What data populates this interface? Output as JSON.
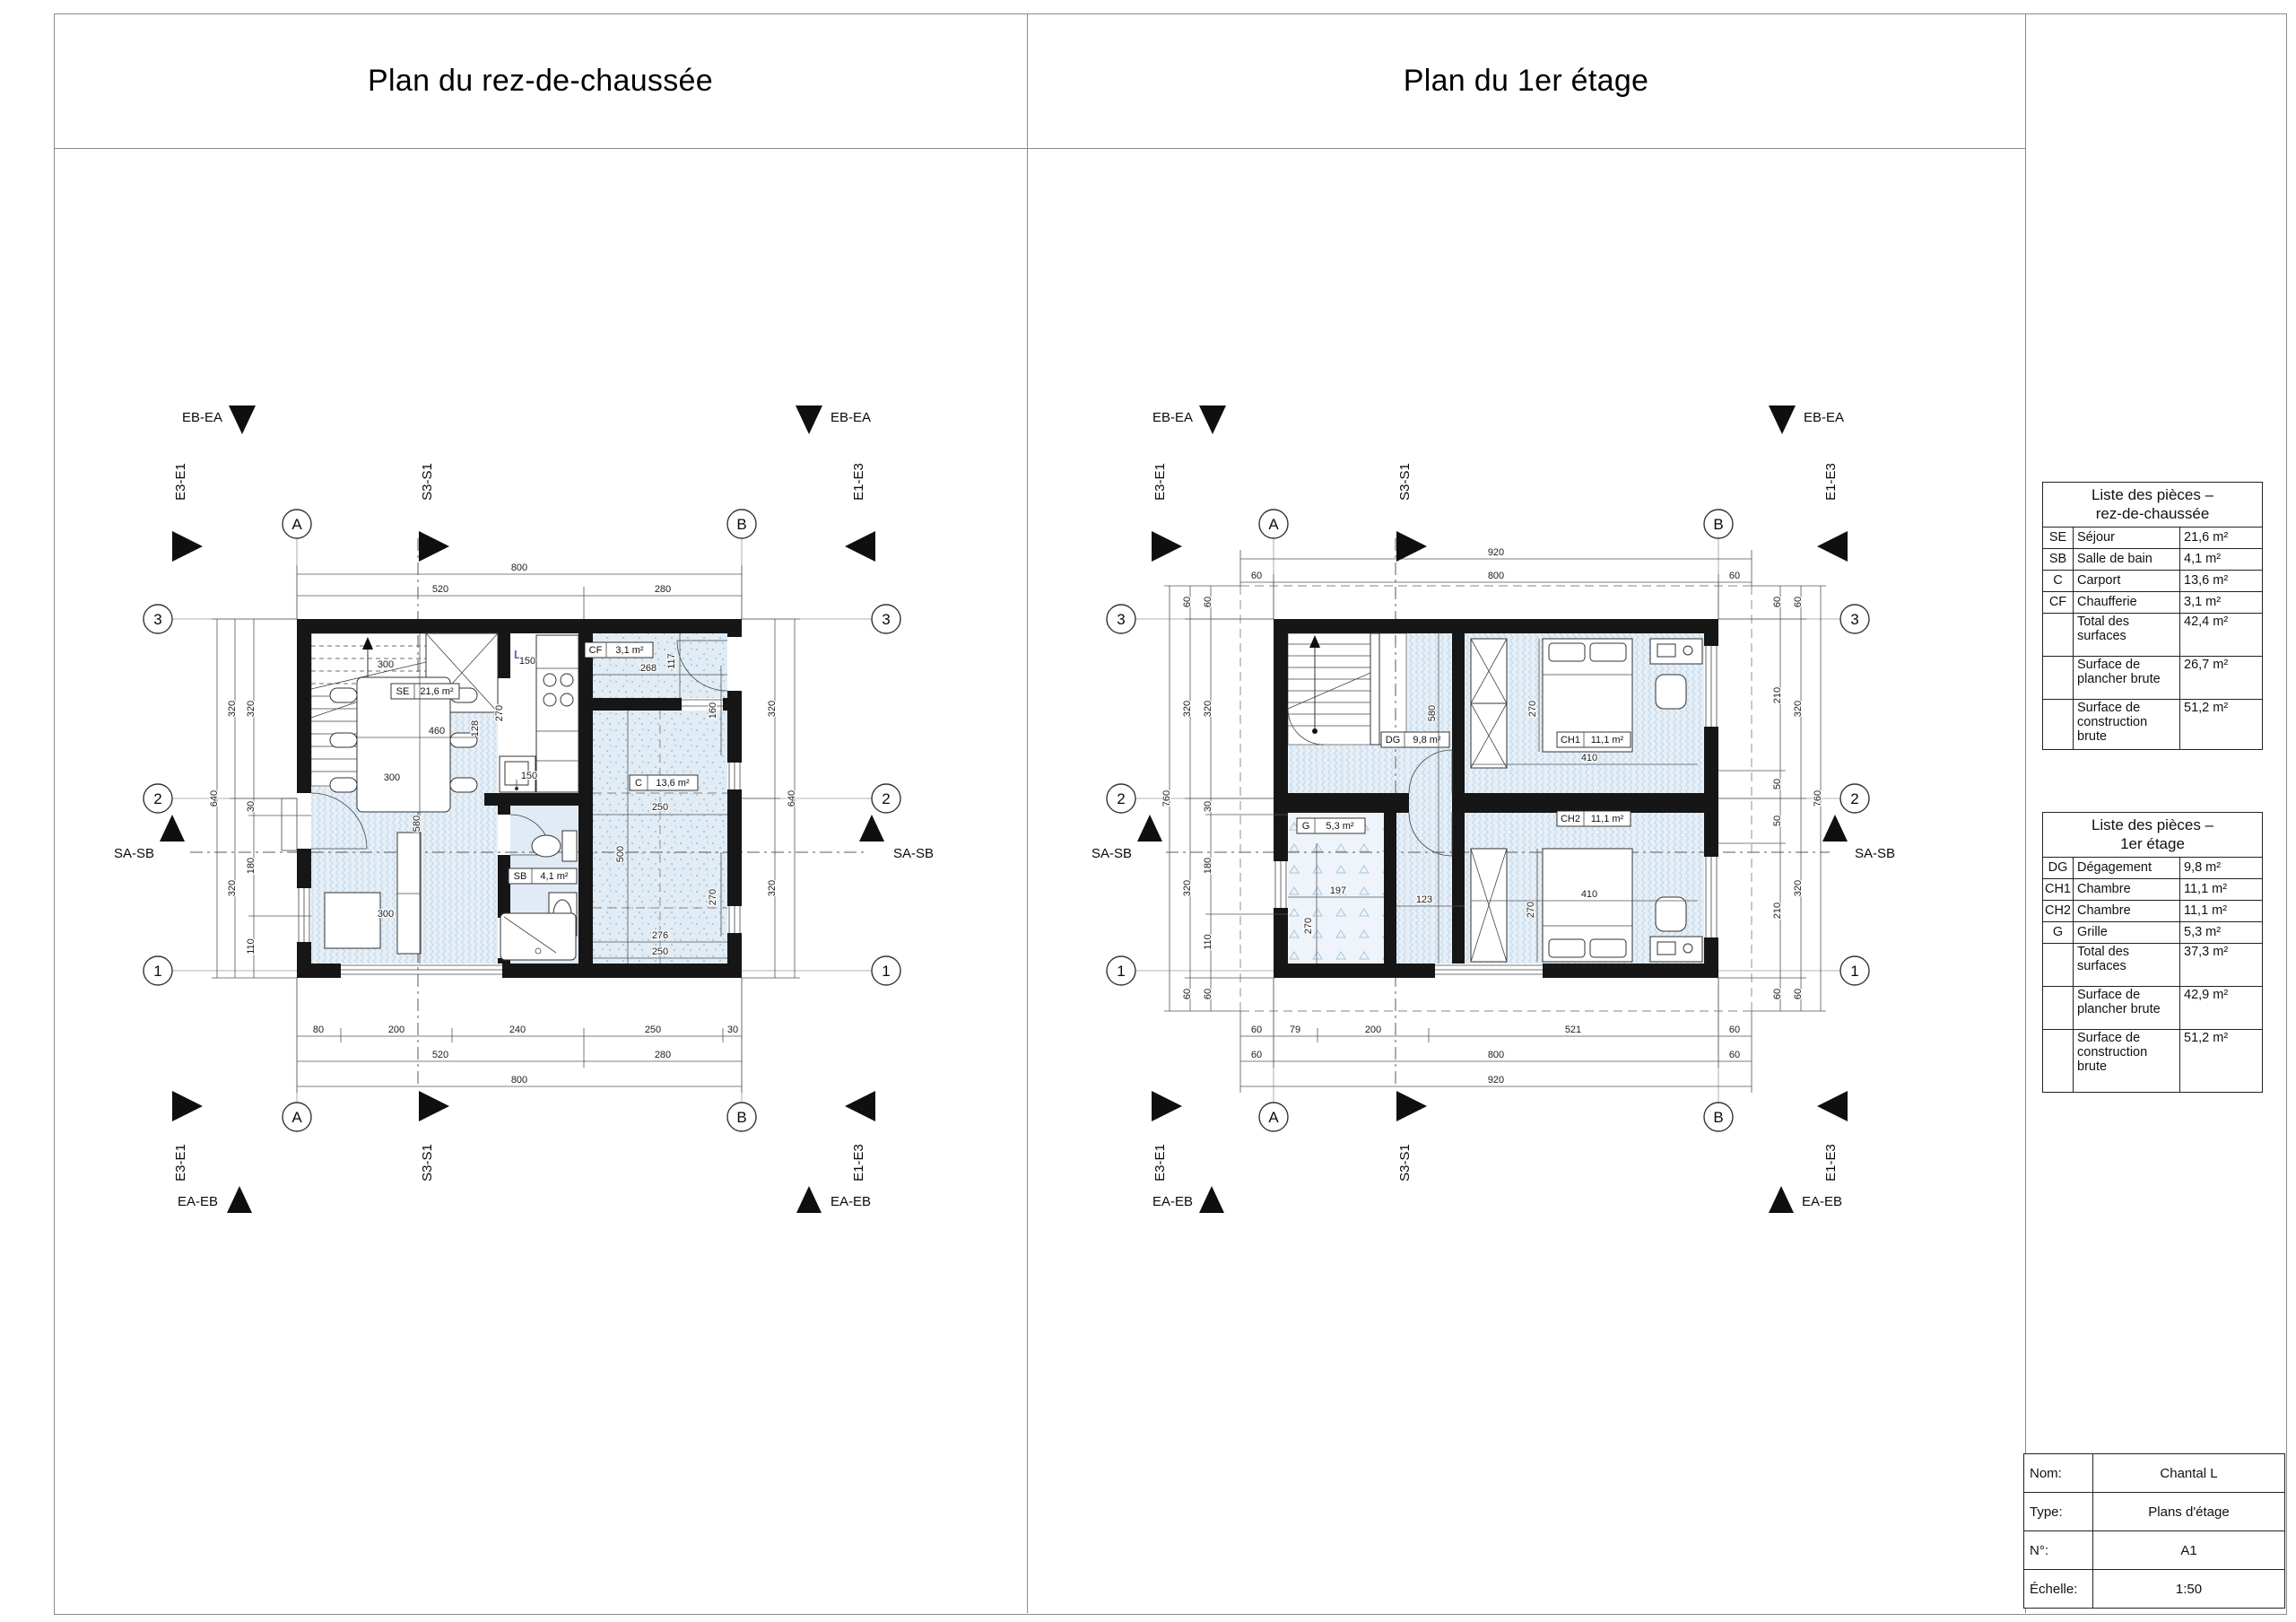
{
  "sheet": {
    "title_left": "Plan du rez-de-chaussée",
    "title_right": "Plan du 1er étage"
  },
  "markers": {
    "grid_a": "A",
    "grid_b": "B",
    "grid_1": "1",
    "grid_2": "2",
    "grid_3": "3",
    "eb_ea": "EB-EA",
    "ea_eb": "EA-EB",
    "e3_e1": "E3-E1",
    "e1_e3": "E1-E3",
    "s3_s1": "S3-S1",
    "sa_sb": "SA-SB"
  },
  "plan1": {
    "rooms": {
      "se": {
        "code": "SE",
        "area": "21,6 m²"
      },
      "sb": {
        "code": "SB",
        "area": "4,1 m²"
      },
      "c": {
        "code": "C",
        "area": "13,6 m²"
      },
      "cf": {
        "code": "CF",
        "area": "3,1 m²"
      }
    },
    "kitchen_label": "L",
    "dims": {
      "top": [
        "800",
        "520",
        "280"
      ],
      "bottom": [
        "80",
        "200",
        "240",
        "250",
        "30",
        "520",
        "280",
        "800"
      ],
      "left": [
        "640",
        "320",
        "320",
        "320",
        "30",
        "180",
        "110"
      ],
      "right": [
        "320",
        "320",
        "640"
      ],
      "interior": [
        "300",
        "460",
        "128",
        "270",
        "150",
        "150",
        "300",
        "580",
        "300"
      ],
      "carport": [
        "268",
        "117",
        "160",
        "250",
        "500",
        "270",
        "276",
        "250"
      ]
    }
  },
  "plan2": {
    "rooms": {
      "dg": {
        "code": "DG",
        "area": "9,8 m²"
      },
      "ch1": {
        "code": "CH1",
        "area": "11,1 m²"
      },
      "ch2": {
        "code": "CH2",
        "area": "11,1 m²"
      },
      "g": {
        "code": "G",
        "area": "5,3 m²"
      }
    },
    "dims": {
      "top": [
        "920",
        "60",
        "800",
        "60"
      ],
      "bottom": [
        "60",
        "79",
        "200",
        "521",
        "60",
        "60",
        "800",
        "60",
        "920"
      ],
      "left": [
        "760",
        "60",
        "320",
        "320",
        "60",
        "60",
        "320",
        "30",
        "180",
        "110",
        "60"
      ],
      "right": [
        "60",
        "210",
        "50",
        "50",
        "210",
        "60",
        "320",
        "320",
        "60",
        "60",
        "760"
      ],
      "interior": [
        "580",
        "123",
        "197",
        "270",
        "410",
        "270",
        "410",
        "270"
      ]
    }
  },
  "tables": {
    "rdc": {
      "title": "Liste des pièces –",
      "subtitle": "rez-de-chaussée",
      "rows": [
        {
          "code": "SE",
          "name": "Séjour",
          "area": "21,6 m²"
        },
        {
          "code": "SB",
          "name": "Salle de bain",
          "area": "4,1 m²"
        },
        {
          "code": "C",
          "name": "Carport",
          "area": "13,6 m²"
        },
        {
          "code": "CF",
          "name": "Chaufferie",
          "area": "3,1 m²"
        }
      ],
      "summary": [
        {
          "name": "Total des surfaces",
          "area": "42,4 m²"
        },
        {
          "name": "Surface de plancher brute",
          "area": "26,7 m²"
        },
        {
          "name": "Surface de construction brute",
          "area": "51,2 m²"
        }
      ]
    },
    "etage": {
      "title": "Liste des pièces –",
      "subtitle": "1er étage",
      "rows": [
        {
          "code": "DG",
          "name": "Dégagement",
          "area": "9,8 m²"
        },
        {
          "code": "CH1",
          "name": "Chambre",
          "area": "11,1 m²"
        },
        {
          "code": "CH2",
          "name": "Chambre",
          "area": "11,1 m²"
        },
        {
          "code": "G",
          "name": "Grille",
          "area": "5,3 m²"
        }
      ],
      "summary": [
        {
          "name": "Total des surfaces",
          "area": "37,3 m²"
        },
        {
          "name": "Surface de plancher brute",
          "area": "42,9 m²"
        },
        {
          "name": "Surface de construction brute",
          "area": "51,2 m²"
        }
      ]
    }
  },
  "titleblock": {
    "rows": [
      {
        "label": "Nom:",
        "value": "Chantal L"
      },
      {
        "label": "Type:",
        "value": "Plans d'étage"
      },
      {
        "label": "N°:",
        "value": "A1"
      },
      {
        "label": "Échelle:",
        "value": "1:50"
      }
    ]
  }
}
